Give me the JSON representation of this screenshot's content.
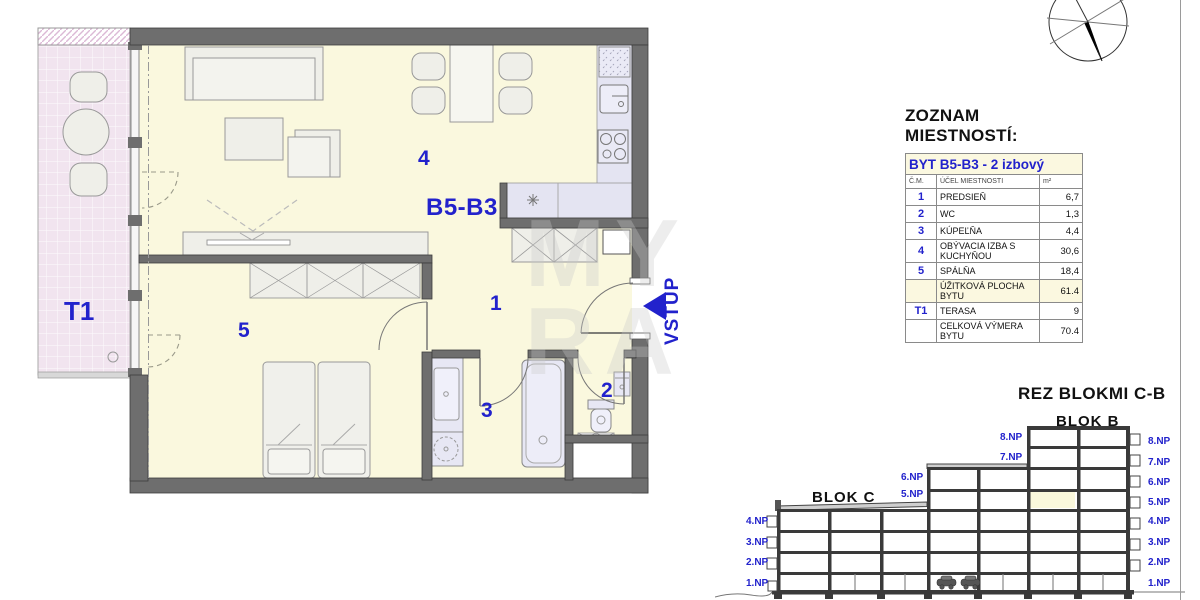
{
  "plan": {
    "apartment_label": "B5-B3",
    "entrance_label": "VSTUP",
    "room_labels": {
      "hall": "1",
      "wc": "2",
      "bathroom": "3",
      "living": "4",
      "bedroom": "5",
      "terrace": "T1"
    }
  },
  "watermark": {
    "line1": "MY",
    "line2": "RA"
  },
  "room_table": {
    "title": "ZOZNAM MIESTNOSTÍ:",
    "apartment_header": "BYT B5-B3 - 2 izbový",
    "columns": {
      "num": "Č.M.",
      "name": "ÚČEL MIESTNOSTI",
      "area": "m²"
    },
    "rows": [
      {
        "num": "1",
        "name": "PREDSIEŇ",
        "area": "6,7"
      },
      {
        "num": "2",
        "name": "WC",
        "area": "1,3"
      },
      {
        "num": "3",
        "name": "KÚPEĽŇA",
        "area": "4,4"
      },
      {
        "num": "4",
        "name": "OBÝVACIA IZBA S KUCHYŇOU",
        "area": "30,6"
      },
      {
        "num": "5",
        "name": "SPÁLŇA",
        "area": "18,4"
      },
      {
        "num": "",
        "name": "ÚŽITKOVÁ PLOCHA BYTU",
        "area": "61.4"
      },
      {
        "num": "T1",
        "name": "TERASA",
        "area": "9"
      },
      {
        "num": "",
        "name": "CELKOVÁ VÝMERA BYTU",
        "area": "70.4"
      }
    ]
  },
  "section": {
    "title": "REZ BLOKMI C-B",
    "blok_b": "BLOK B",
    "blok_c": "BLOK C",
    "left_floors": [
      "4.NP",
      "3.NP",
      "2.NP",
      "1.NP"
    ],
    "mid_upper_floors": [
      "8.NP",
      "7.NP"
    ],
    "mid_lower_floors": [
      "6.NP",
      "5.NP"
    ],
    "right_floors": [
      "8.NP",
      "7.NP",
      "6.NP",
      "5.NP",
      "4.NP",
      "3.NP",
      "2.NP",
      "1.NP"
    ]
  },
  "colors": {
    "accent_blue": "#2222CC",
    "floor_yellow": "#FAF8DE",
    "terrace_pink": "#F1E4EF",
    "wall_gray": "#6E6E6E",
    "counter_lavender": "#E4E4F2",
    "table_cream": "#FBF8E0",
    "section_highlight": "#FAF8DC"
  }
}
